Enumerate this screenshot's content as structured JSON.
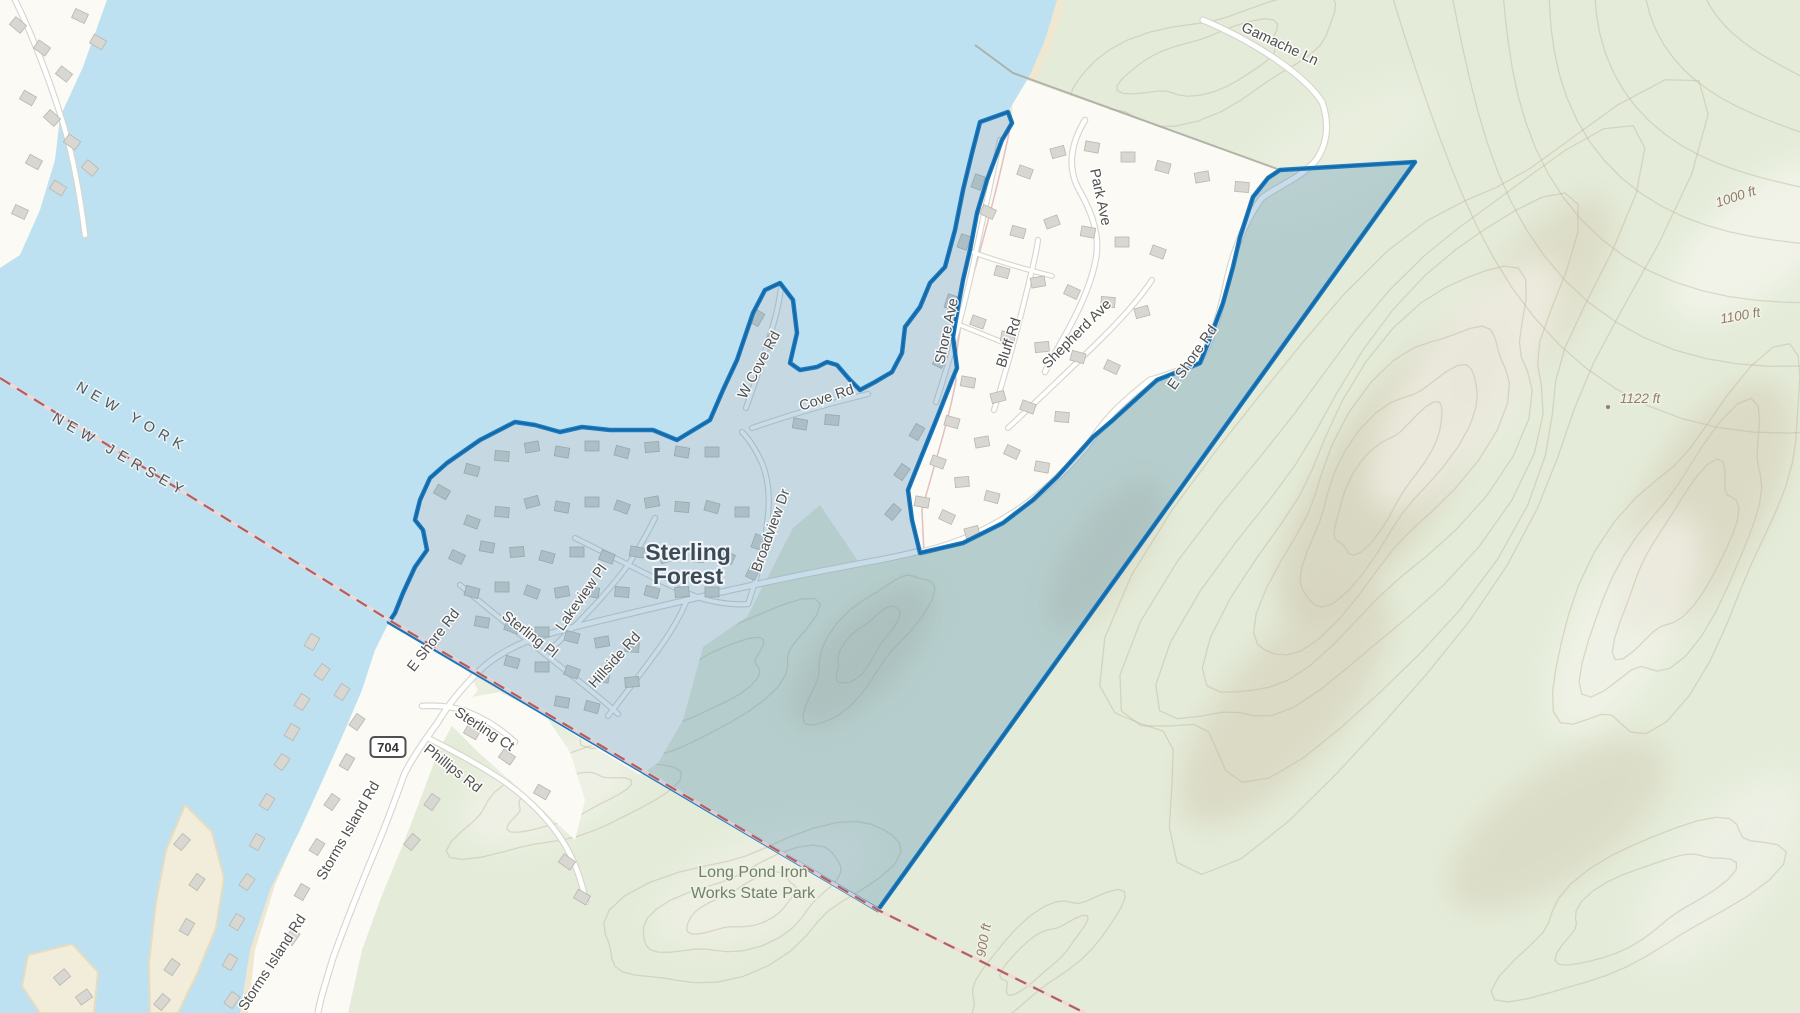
{
  "map": {
    "description": "Topographic web-map with highlighted boundary polygon around Sterling Forest on the east shore of Greenwood Lake",
    "place_labels": [
      {
        "id": "sterling-forest",
        "lines": [
          "Sterling",
          "Forest"
        ],
        "x": 688,
        "y": 560,
        "line_height": 24
      },
      {
        "id": "state-park",
        "lines": [
          "Long Pond Iron",
          "Works State Park"
        ],
        "x": 753,
        "y": 877,
        "line_height": 21
      }
    ],
    "boundary_labels": [
      {
        "text": "NEW YORK",
        "x": 130,
        "y": 421,
        "rot": 30
      },
      {
        "text": "NEW JERSEY",
        "x": 118,
        "y": 459,
        "rot": 30
      }
    ],
    "road_labels": [
      {
        "text": "Gamache Ln",
        "x": 1278,
        "y": 48,
        "rot": 25
      },
      {
        "text": "Park Ave",
        "x": 1096,
        "y": 198,
        "rot": 78
      },
      {
        "text": "Bluff Rd",
        "x": 1013,
        "y": 344,
        "rot": -72
      },
      {
        "text": "Shepherd Ave",
        "x": 1080,
        "y": 337,
        "rot": -45
      },
      {
        "text": "Shore Ave",
        "x": 951,
        "y": 332,
        "rot": -78
      },
      {
        "text": "E Shore Rd",
        "x": 1196,
        "y": 360,
        "rot": -55
      },
      {
        "text": "E Shore Rd",
        "x": 437,
        "y": 643,
        "rot": -52
      },
      {
        "text": "Cove Rd",
        "x": 828,
        "y": 402,
        "rot": -18
      },
      {
        "text": "W Cove Rd",
        "x": 763,
        "y": 367,
        "rot": -62
      },
      {
        "text": "Broadview Dr",
        "x": 775,
        "y": 532,
        "rot": -70
      },
      {
        "text": "Lakeview Pl",
        "x": 585,
        "y": 600,
        "rot": -55
      },
      {
        "text": "Sterling Pl",
        "x": 527,
        "y": 638,
        "rot": 38
      },
      {
        "text": "Hillside Rd",
        "x": 618,
        "y": 663,
        "rot": -48
      },
      {
        "text": "Sterling Ct",
        "x": 482,
        "y": 733,
        "rot": 33
      },
      {
        "text": "Phillips Rd",
        "x": 450,
        "y": 772,
        "rot": 38
      },
      {
        "text": "Storms Island Rd",
        "x": 352,
        "y": 833,
        "rot": -60
      },
      {
        "text": "Storms Island Rd",
        "x": 276,
        "y": 965,
        "rot": -57
      }
    ],
    "elevation_labels": [
      {
        "text": "1000 ft",
        "x": 1737,
        "y": 201,
        "rot": -18
      },
      {
        "text": "1100 ft",
        "x": 1741,
        "y": 320,
        "rot": -10
      },
      {
        "text": "1122 ft",
        "x": 1640,
        "y": 403,
        "rot": 0,
        "spot": true
      },
      {
        "text": "900 ft",
        "x": 988,
        "y": 941,
        "rot": -80
      }
    ],
    "route_shield": {
      "number": "704",
      "x": 388,
      "y": 747
    },
    "highlighted_area": {
      "name": "Sterling Forest selection polygon"
    },
    "colors": {
      "water": "#bee1f1",
      "land": "#e4ecd9",
      "residential": "#fbfaf5",
      "shore_sand": "#efe7cf",
      "contour": "#c2b69d",
      "road": "#ffffff",
      "road_casing": "#d6d5cc",
      "building": "#d8d7d1",
      "building_stroke": "#b8b7af",
      "highlight_fill": "rgba(55,125,175,0.27)",
      "highlight_border": "#1b7ac2",
      "highlight_border_dark": "#14669f",
      "state_line_dash": "#b06060",
      "state_line_under": "#f2d7d7",
      "muni_line": "#a9a99d",
      "label": "#4f4f4f"
    }
  }
}
